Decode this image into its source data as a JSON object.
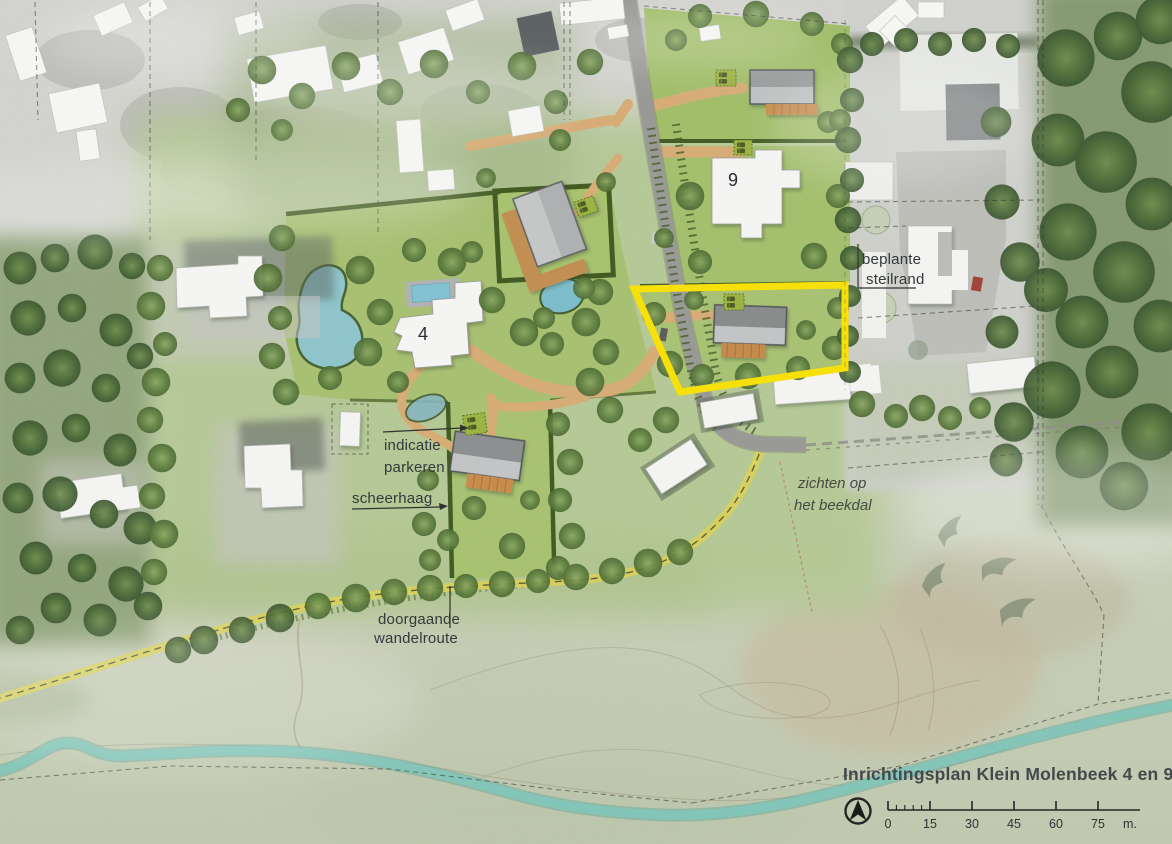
{
  "plan": {
    "title": "Inrichtingsplan Klein Molenbeek 4 en 9",
    "parcel_numbers": {
      "parcel_4": "4",
      "parcel_9": "9"
    },
    "labels": {
      "beplante_line1": "beplante",
      "beplante_line2": "steilrand",
      "parkeren_line1": "indicatie",
      "parkeren_line2": "parkeren",
      "scheerhaag": "scheerhaag",
      "wandelroute_line1": "doorgaande",
      "wandelroute_line2": "wandelroute",
      "zichten_line1": "zichten op",
      "zichten_line2": "het beekdal"
    },
    "scale_bar": {
      "ticks": [
        "0",
        "15",
        "30",
        "45",
        "60",
        "75"
      ],
      "unit": "m."
    },
    "icons": {
      "north_arrow": "north-arrow",
      "bird": "bird-silhouette",
      "car": "parked-car",
      "parking": "parking-square"
    },
    "colors": {
      "highlight_outline": "#FFE600",
      "parcel_green": "#A9C470",
      "hedge_green": "#3D581D",
      "path_tan": "#DCAE76",
      "terrace_brown": "#C98A4A",
      "road_gray": "#9A9A98",
      "walking_route_yellow": "#DDD65E",
      "stream_teal": "#7FC7BD",
      "pond_blue": "#8EC9D6",
      "parking_green": "#9CB544"
    }
  }
}
